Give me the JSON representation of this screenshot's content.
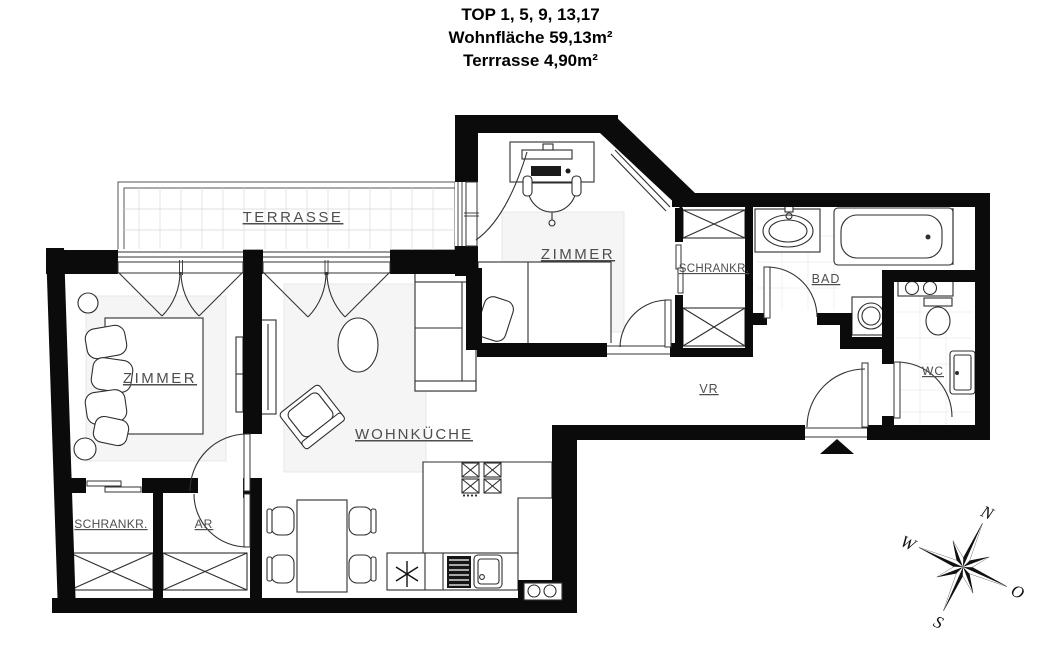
{
  "header": {
    "line1": "TOP 1, 5, 9, 13,17",
    "line2": "Wohnfläche 59,13m²",
    "line3": "Terrrasse 4,90m²"
  },
  "rooms": {
    "terrace": {
      "label": "TERRASSE"
    },
    "bedroom_left": {
      "label": "ZIMMER"
    },
    "bedroom_top": {
      "label": "ZIMMER"
    },
    "living_kitchen": {
      "label": "WOHNKÜCHE"
    },
    "closet_top": {
      "label": "SCHRANKR."
    },
    "bathroom": {
      "label": "BAD"
    },
    "wc": {
      "label": "WC"
    },
    "hallway": {
      "label": "VR"
    },
    "closet_bottom": {
      "label": "SCHRANKR."
    },
    "storage": {
      "label": "AR"
    }
  },
  "compass": {
    "north": "N",
    "east": "O",
    "south": "S",
    "west": "W"
  },
  "icons": {
    "entrance_marker": "entrance-triangle",
    "kitchen_marker": "asterisk-symbol",
    "wardrobe_symbol": "x-cross-box"
  },
  "colors": {
    "wall": "#0b0b0b",
    "furniture_line": "#2e2e2e",
    "label": "#4e4e4e",
    "rug": "#f5f5f5",
    "tile_grid": "#d9d9d9"
  }
}
